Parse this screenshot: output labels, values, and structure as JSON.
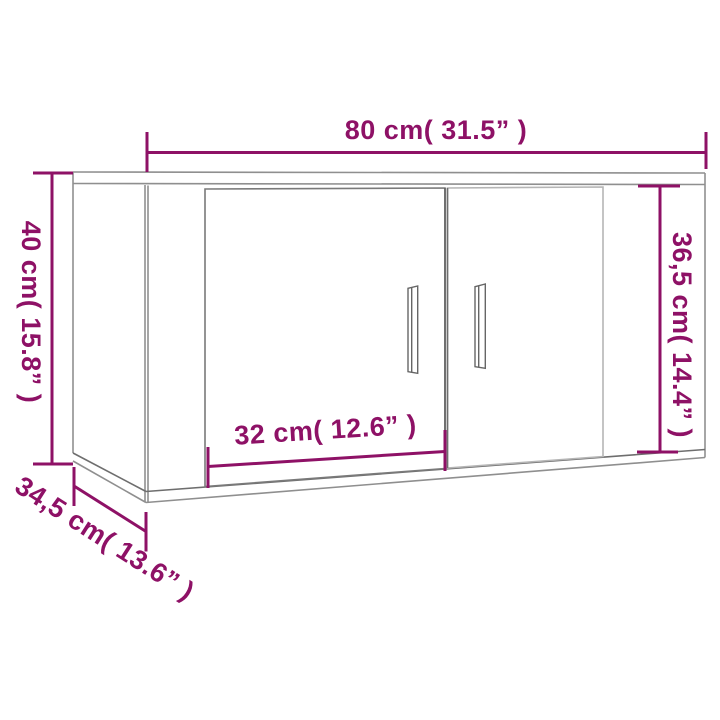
{
  "figure_alt": "Line drawing of a wall-mounted cabinet with two doors, annotated with measurements",
  "colors": {
    "dimension": "#8E1166",
    "outline": "#8f8f8f",
    "outline_dark": "#666666",
    "outline_light": "#b5b5b5",
    "background": "#ffffff"
  },
  "dimensions": {
    "width": {
      "label": "80 cm( 31.5” )"
    },
    "height": {
      "label": "40 cm( 15.8” )"
    },
    "door_height": {
      "label": "36,5 cm( 14.4” )"
    },
    "door_width": {
      "label": "32 cm( 12.6” )"
    },
    "depth": {
      "label": "34,5 cm( 13.6” )"
    }
  }
}
